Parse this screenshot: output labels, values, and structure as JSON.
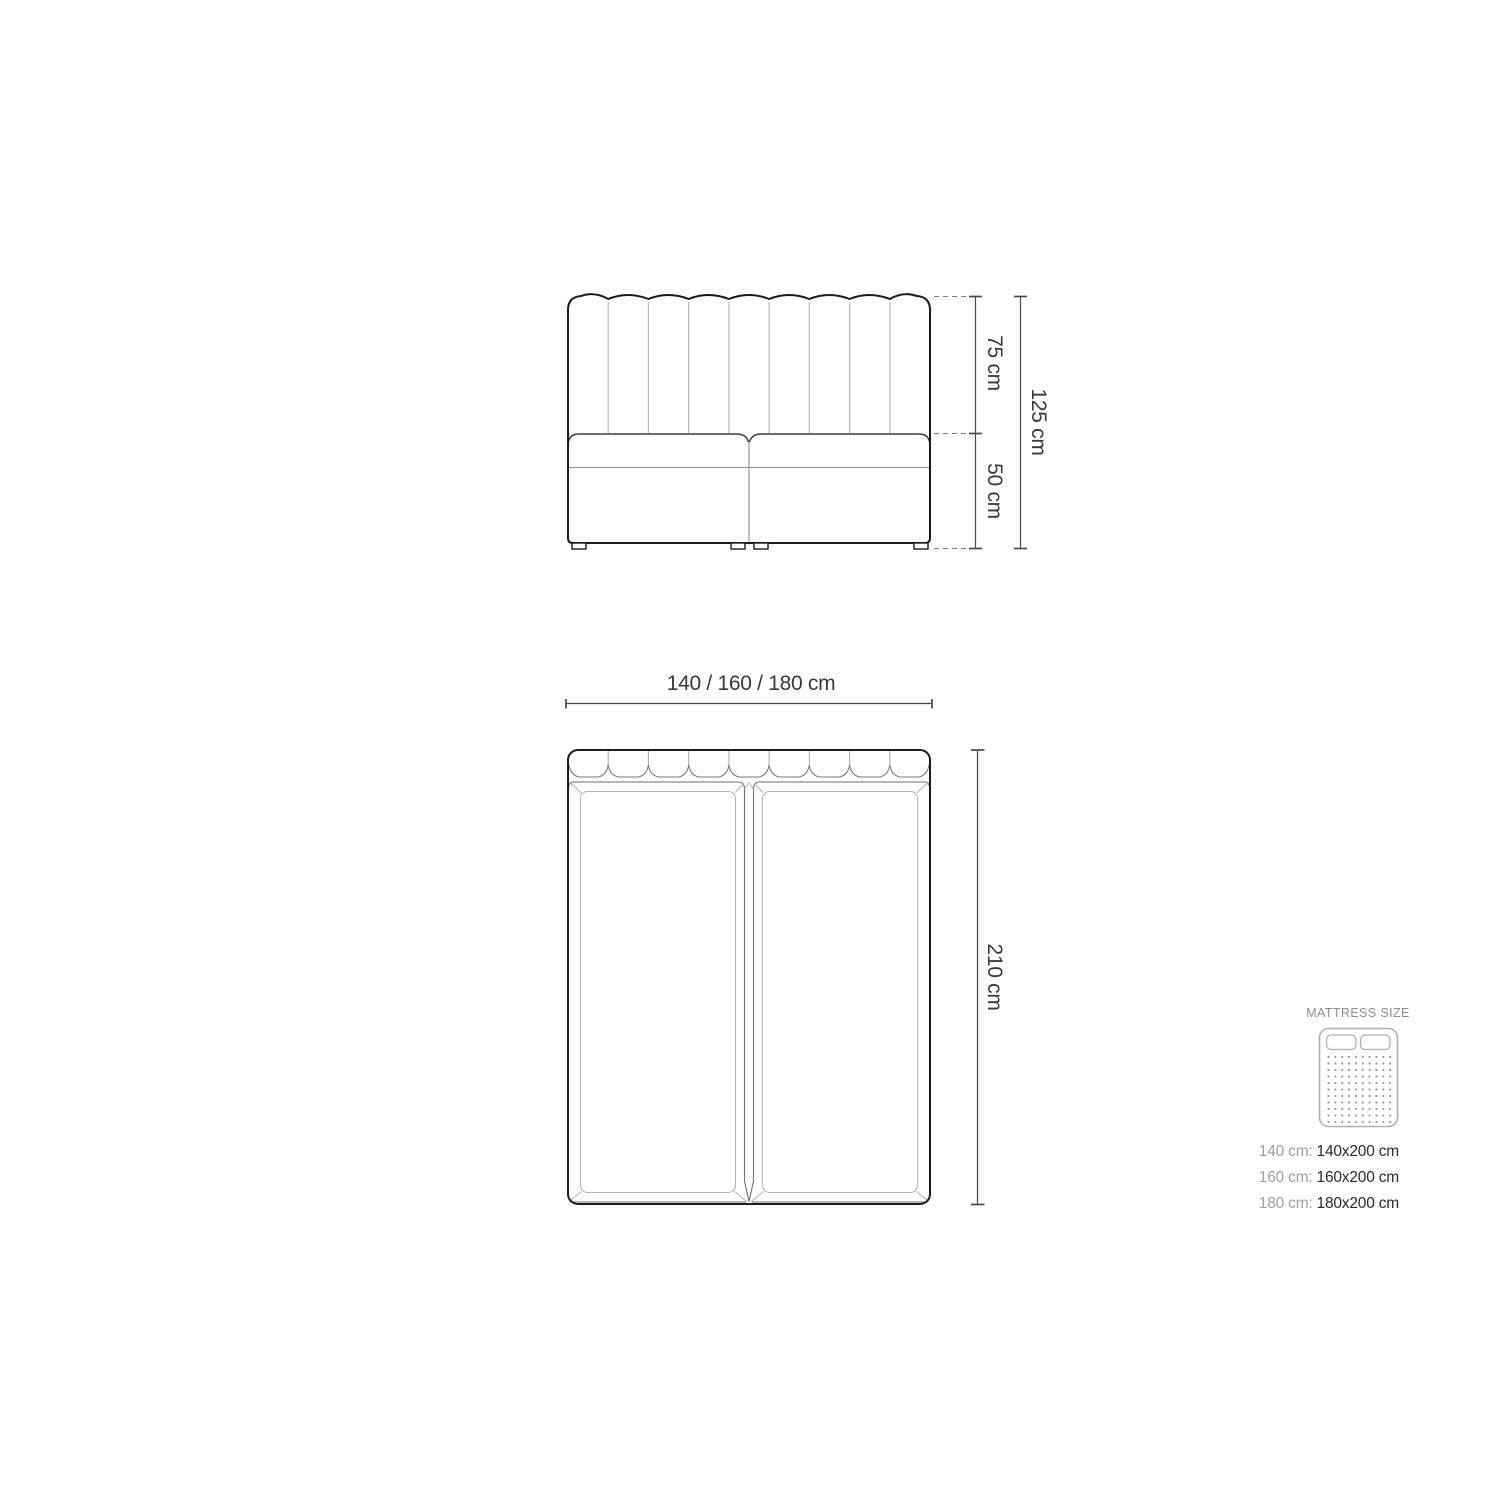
{
  "front_view": {
    "height_upper_label": "75 cm",
    "height_lower_label": "50 cm",
    "height_total_label": "125 cm"
  },
  "top_view": {
    "width_label": "140 / 160 / 180 cm",
    "length_label": "210 cm"
  },
  "legend": {
    "title": "MATTRESS SIZE",
    "sizes": [
      {
        "label": "140 cm:",
        "value": "140x200 cm"
      },
      {
        "label": "160 cm:",
        "value": "160x200 cm"
      },
      {
        "label": "180 cm:",
        "value": "180x200 cm"
      }
    ]
  },
  "colors": {
    "outline": "#1c1c1c",
    "thin_line": "#b3b3b3",
    "mid_line": "#8f8f8f",
    "dim_line": "#4a4a4a",
    "dashed_line": "#808080",
    "text": "#3a3a3a",
    "muted_text": "#a0a0a0"
  }
}
